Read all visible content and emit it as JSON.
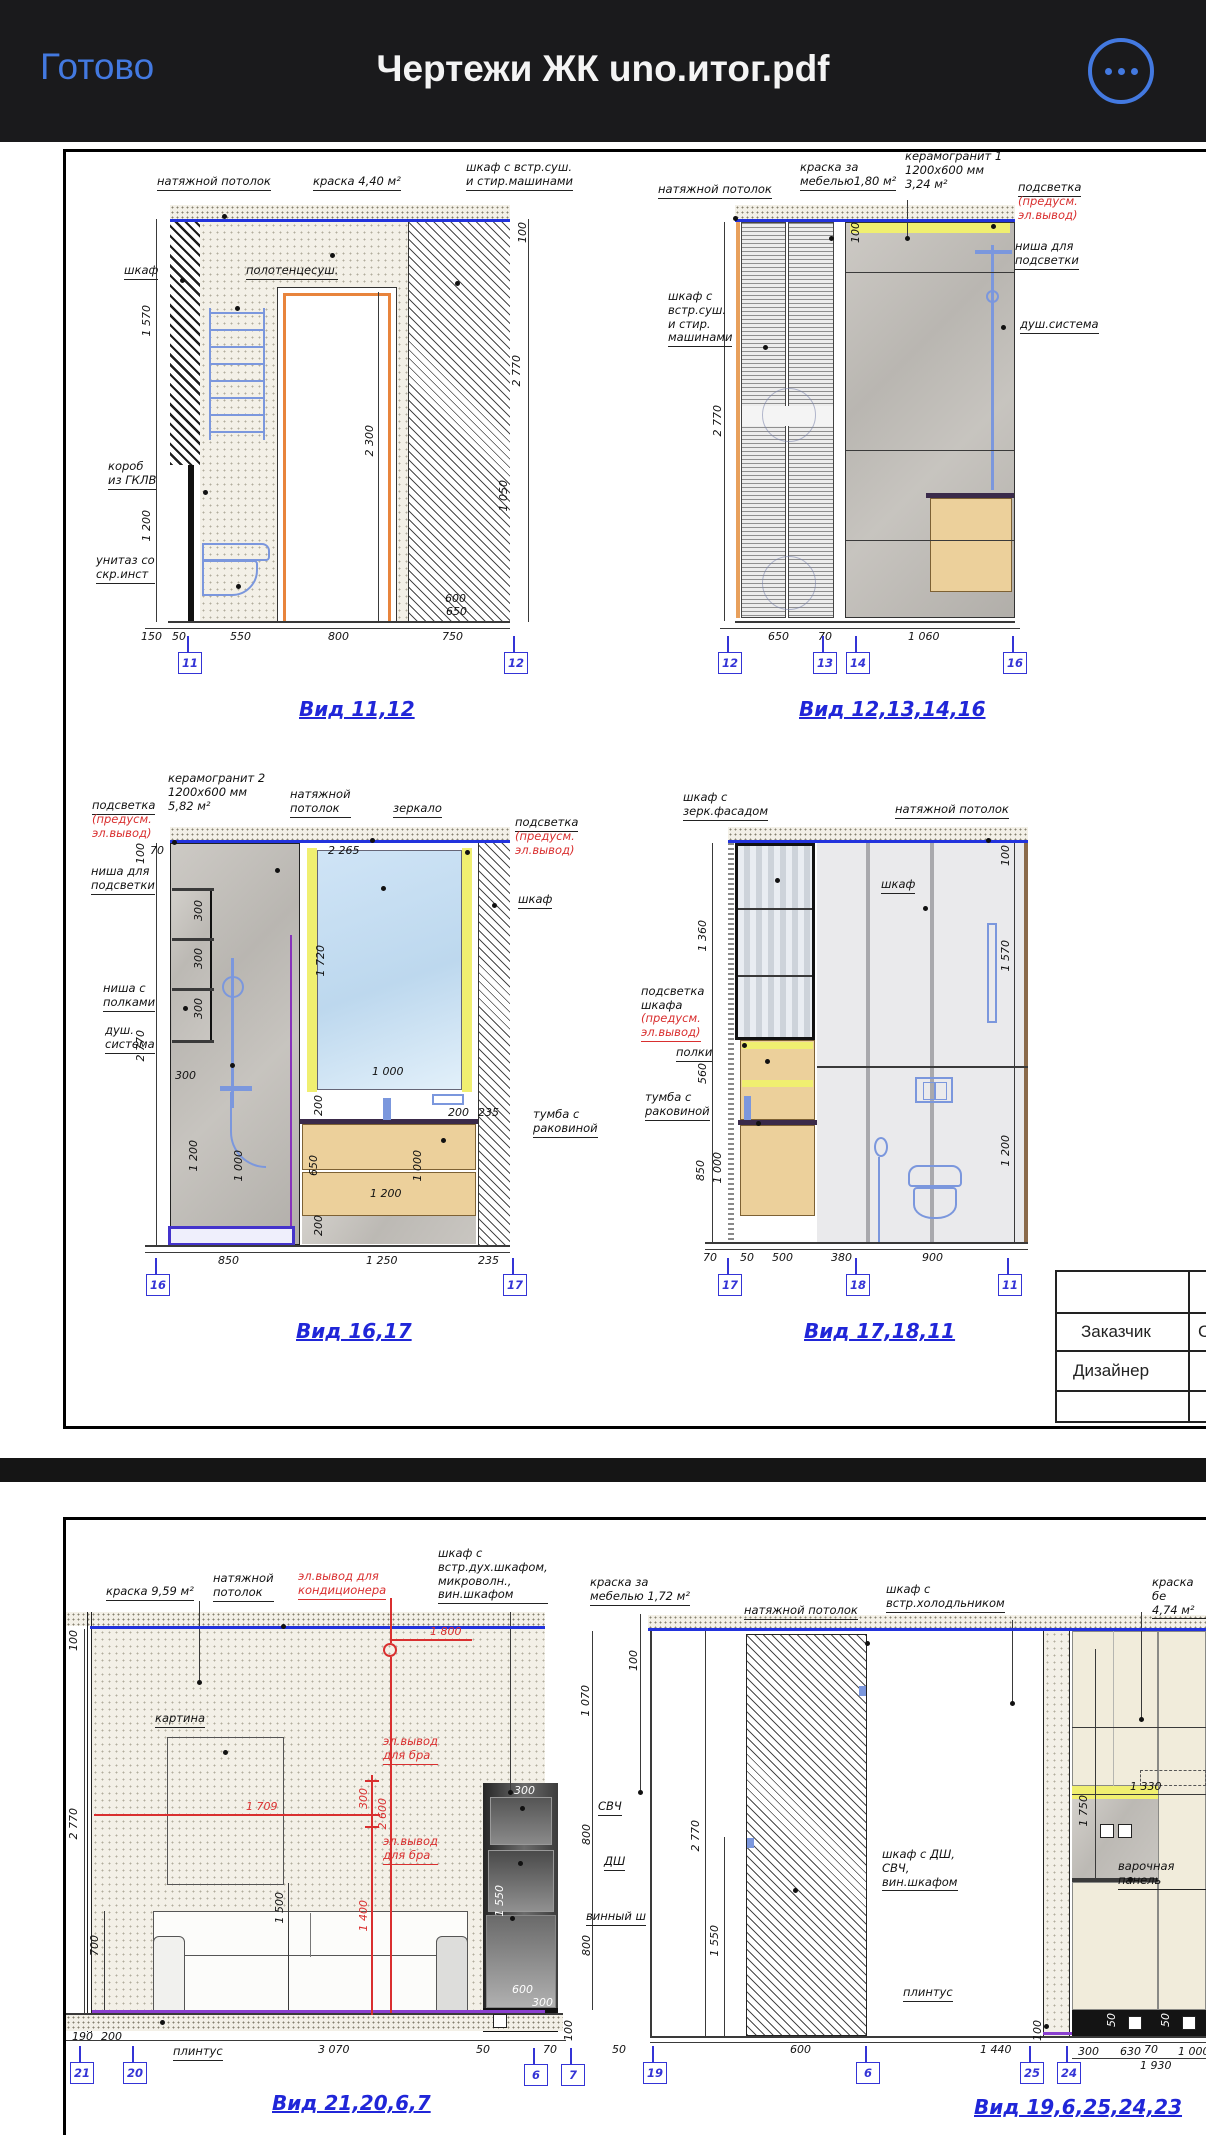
{
  "topbar": {
    "done": "Готово",
    "title": "Чертежи ЖК uno.итог.pdf"
  },
  "accent": "#4379e0",
  "p1": {
    "d1": {
      "c": [
        "натяжной потолок",
        "краска 4,40 м²",
        "шкаф с встр.суш.\nи стир.машинами",
        "шкаф",
        "полотенцесуш.",
        "короб\nиз ГКЛВ",
        "унитаз со\nскр.инст"
      ],
      "d": [
        "1 570",
        "1 200",
        "2 300",
        "100",
        "2 770",
        "1 050",
        "600",
        "650",
        "150",
        "50",
        "550",
        "800",
        "750"
      ],
      "m": [
        "11",
        "12"
      ],
      "cap": "Вид 11,12"
    },
    "d2": {
      "c": [
        "натяжной потолок",
        "краска за\nмебелью1,80 м²",
        "керамогранит 1\n1200х600 мм\n3,24 м²",
        "подсветка",
        "(предусм.\nэл.вывод)",
        "ниша для\nподсветки",
        "душ.система",
        "шкаф с\nвстр.суш.\nи стир.\nмашинами"
      ],
      "d": [
        "100",
        "2 770",
        "650",
        "70",
        "1 060"
      ],
      "m": [
        "12",
        "13",
        "14",
        "16"
      ],
      "cap": "Вид 12,13,14,16"
    },
    "d3": {
      "c": [
        "подсветка",
        "(предусм.\nэл.вывод)",
        "керамогранит 2\n1200х600 мм\n5,82 м²",
        "натяжной\nпотолок",
        "зеркало",
        "подсветка",
        "(предусм.\nэл.вывод)",
        "шкаф",
        "ниша для\nподсветки",
        "ниша с\nполками",
        "душ.\nсистема",
        "тумба с\nраковиной"
      ],
      "d": [
        "100",
        "70",
        "2 265",
        "300",
        "300",
        "300",
        "300",
        "2 770",
        "1 720",
        "1 000",
        "200",
        "200",
        "235",
        "650",
        "1 000",
        "1 200",
        "200",
        "1 200",
        "1 000",
        "850",
        "1 250",
        "235"
      ],
      "m": [
        "16",
        "17"
      ],
      "cap": "Вид 16,17"
    },
    "d4": {
      "c": [
        "шкаф с\nзерк.фасадом",
        "натяжной потолок",
        "шкаф",
        "подсветка\nшкафа",
        "(предусм.\nэл.вывод)",
        "полки",
        "тумба с\nраковиной"
      ],
      "d": [
        "100",
        "1 360",
        "1 570",
        "560",
        "850",
        "1 000",
        "1 200",
        "70",
        "50",
        "500",
        "380",
        "900"
      ],
      "m": [
        "17",
        "18",
        "11"
      ],
      "cap": "Вид 17,18,11"
    },
    "tb": {
      "r1": "Заказчик",
      "r2": "Дизайнер",
      "partial": "С"
    }
  },
  "p2": {
    "d5": {
      "c": [
        "краска 9,59 м²",
        "натяжной\nпотолок",
        "эл.вывод для\nкондиционера",
        "шкаф с\nвстр.дух.шкафом,\nмикроволн.,\nвин.шкафом",
        "картина",
        "эл.вывод\nдля бра",
        "эл.вывод\nдля бра",
        "СВЧ",
        "ДШ",
        "винный ш",
        "плинтус"
      ],
      "d": [
        "100",
        "2 770",
        "700",
        "1 500",
        "1 070",
        "800",
        "800",
        "190",
        "200",
        "3 070",
        "50",
        "70",
        "100",
        "300",
        "1 550",
        "600",
        "300"
      ],
      "rd": [
        "1 800",
        "1 709",
        "2 600",
        "300",
        "1 400"
      ],
      "m": [
        "21",
        "20",
        "6",
        "7"
      ],
      "cap": "Вид 21,20,6,7"
    },
    "d6": {
      "c": [
        "краска за\nмебелью 1,72 м²",
        "натяжной потолок",
        "шкаф с\nвстр.холодльником",
        "краска бе\n4,74 м²",
        "шкаф с ДШ,\nСВЧ,\nвин.шкафом",
        "варочная панель",
        "плинтус"
      ],
      "d": [
        "100",
        "2 770",
        "1 550",
        "50",
        "600",
        "1 440",
        "70",
        "1 330",
        "1 750",
        "100",
        "300",
        "630",
        "1 000",
        "1 930",
        "50",
        "50"
      ],
      "m": [
        "19",
        "6",
        "25",
        "24"
      ],
      "cap": "Вид 19,6,25,24,23"
    }
  }
}
